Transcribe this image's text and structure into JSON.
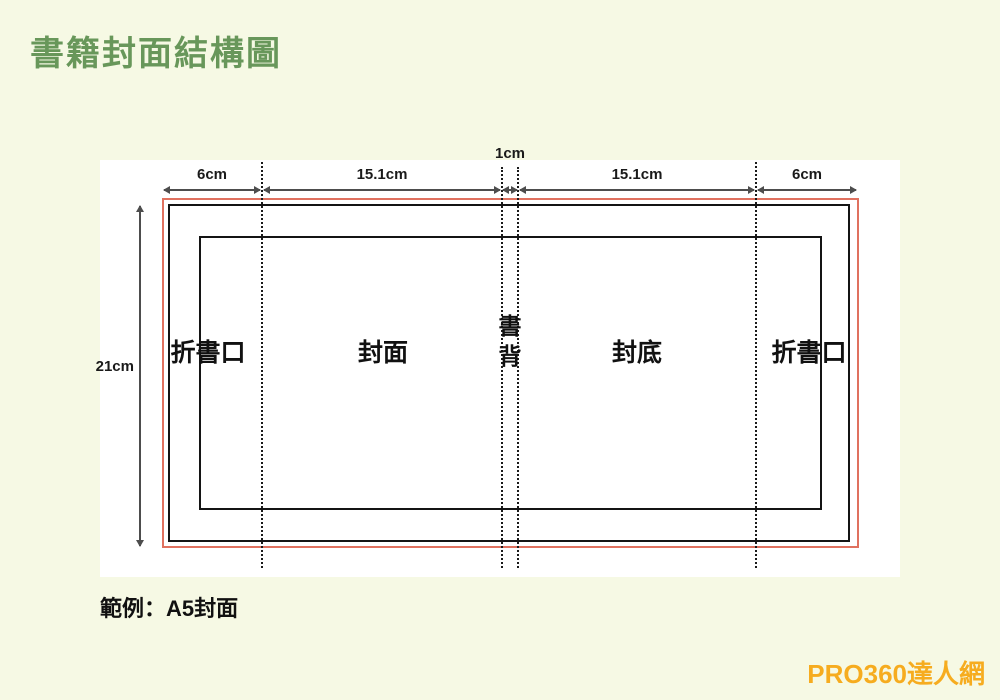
{
  "page": {
    "title": "書籍封面結構圖",
    "caption": "範例：A5封面",
    "brand": "PRO360達人網"
  },
  "diagram": {
    "dimensions": {
      "flap_left": "6cm",
      "front_cover": "15.1cm",
      "spine": "1cm",
      "back_cover": "15.1cm",
      "flap_right": "6cm",
      "height": "21cm"
    },
    "zones": {
      "flap_left": "折書口",
      "front_cover": "封面",
      "spine": "書背",
      "back_cover": "封底",
      "flap_right": "折書口"
    },
    "colors": {
      "background": "#f6f9e4",
      "title_green": "#68975a",
      "bleed_line_red": "#e0715f",
      "trim_line_black": "#141414",
      "arrow_gray": "#4d4d4d",
      "brand_orange": "#f6ac1f",
      "panel_white": "#ffffff"
    }
  }
}
